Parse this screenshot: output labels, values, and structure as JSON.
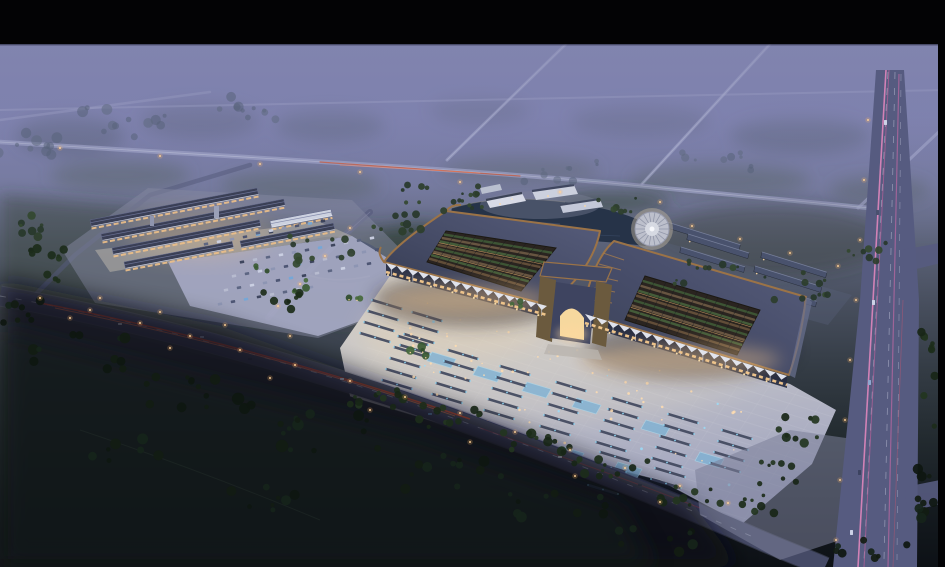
{
  "scene": {
    "kind": "aerial architectural rendering at dusk",
    "subject": "large Chinese-style market hall complex with illuminated plaza, secondary market buildings, parking lots, pond, round pavilion, highways and dark farm fields",
    "letterbox": {
      "top_bar": true,
      "right_bar": true
    }
  },
  "palette": {
    "bar-black": "#030305",
    "mist": "#7c7fab",
    "copper": "#9b7347",
    "roof-slate": "#3a3f55",
    "roof-slate-east": "#49526d",
    "opening-dark": "#2a2420",
    "plaza-warm": "#d8d1c5",
    "plaza-cool": "#9fa3bf",
    "road": "#454a66",
    "road-vertical": "#565b80",
    "water": "#263348",
    "water-west": "#22304a",
    "warm-light": "#ffd398",
    "warm-glow": "#f7c98e",
    "blue-light": "#8fd9f8",
    "pink-streak": "#e789c0",
    "red-streak": "#cf4a34",
    "tree-dark": "#1c2c1a",
    "field-dark": "#0b0f14",
    "white-awning": "#e8ebf4"
  },
  "decor": {
    "tree_tones": {
      "mist": [
        "#57637a",
        "#5e6a80"
      ],
      "mid": [
        "#2c3e2b",
        "#33482f",
        "#27372a"
      ],
      "dark": [
        "#1c2c1a",
        "#233520",
        "#182617"
      ],
      "vdark": [
        "#121c12",
        "#16241a",
        "#0e1710"
      ],
      "bright": [
        "#3a5a33",
        "#47693c",
        "#2f4c2a"
      ]
    },
    "tree_clusters": [
      {
        "x": 30,
        "y": 140,
        "rx": 40,
        "ry": 16,
        "n": 12,
        "tone": "mist",
        "s": 1.2
      },
      {
        "x": 130,
        "y": 122,
        "rx": 50,
        "ry": 15,
        "n": 12,
        "tone": "mist",
        "s": 1.2
      },
      {
        "x": 235,
        "y": 108,
        "rx": 45,
        "ry": 13,
        "n": 10,
        "tone": "mist",
        "s": 1.1
      },
      {
        "x": 45,
        "y": 265,
        "rx": 25,
        "ry": 18,
        "n": 10,
        "tone": "dark",
        "s": 1.1
      },
      {
        "x": 25,
        "y": 228,
        "rx": 20,
        "ry": 13,
        "n": 8,
        "tone": "mid",
        "s": 1
      },
      {
        "x": 320,
        "y": 252,
        "rx": 33,
        "ry": 17,
        "n": 12,
        "tone": "mid",
        "s": 1
      },
      {
        "x": 398,
        "y": 226,
        "rx": 28,
        "ry": 13,
        "n": 10,
        "tone": "mid",
        "s": 0.9
      },
      {
        "x": 282,
        "y": 300,
        "rx": 20,
        "ry": 11,
        "n": 8,
        "tone": "dark",
        "s": 0.9
      },
      {
        "x": 440,
        "y": 192,
        "rx": 42,
        "ry": 11,
        "n": 10,
        "tone": "mid",
        "s": 0.8
      },
      {
        "x": 560,
        "y": 172,
        "rx": 48,
        "ry": 11,
        "n": 9,
        "tone": "mist",
        "s": 0.9
      },
      {
        "x": 700,
        "y": 162,
        "rx": 55,
        "ry": 12,
        "n": 9,
        "tone": "mist",
        "s": 0.9
      },
      {
        "x": 700,
        "y": 270,
        "rx": 38,
        "ry": 15,
        "n": 11,
        "tone": "mid",
        "s": 0.8
      },
      {
        "x": 800,
        "y": 287,
        "rx": 38,
        "ry": 15,
        "n": 11,
        "tone": "mid",
        "s": 0.8
      },
      {
        "x": 862,
        "y": 252,
        "rx": 24,
        "ry": 11,
        "n": 8,
        "tone": "mid",
        "s": 0.8
      },
      {
        "x": 380,
        "y": 398,
        "rx": 30,
        "ry": 11,
        "n": 11,
        "tone": "dark",
        "s": 1
      },
      {
        "x": 452,
        "y": 416,
        "rx": 34,
        "ry": 11,
        "n": 12,
        "tone": "dark",
        "s": 1
      },
      {
        "x": 532,
        "y": 442,
        "rx": 38,
        "ry": 11,
        "n": 12,
        "tone": "dark",
        "s": 1.05
      },
      {
        "x": 612,
        "y": 468,
        "rx": 38,
        "ry": 11,
        "n": 12,
        "tone": "dark",
        "s": 1.05
      },
      {
        "x": 690,
        "y": 494,
        "rx": 33,
        "ry": 11,
        "n": 10,
        "tone": "dark",
        "s": 1
      },
      {
        "x": 80,
        "y": 352,
        "rx": 48,
        "ry": 18,
        "n": 12,
        "tone": "vdark",
        "s": 1.3
      },
      {
        "x": 200,
        "y": 392,
        "rx": 58,
        "ry": 20,
        "n": 14,
        "tone": "vdark",
        "s": 1.3
      },
      {
        "x": 330,
        "y": 432,
        "rx": 58,
        "ry": 20,
        "n": 14,
        "tone": "vdark",
        "s": 1.3
      },
      {
        "x": 450,
        "y": 472,
        "rx": 52,
        "ry": 18,
        "n": 12,
        "tone": "vdark",
        "s": 1.25
      },
      {
        "x": 558,
        "y": 506,
        "rx": 48,
        "ry": 16,
        "n": 10,
        "tone": "vdark",
        "s": 1.2
      },
      {
        "x": 120,
        "y": 452,
        "rx": 40,
        "ry": 15,
        "n": 8,
        "tone": "vdark",
        "s": 1.2
      },
      {
        "x": 262,
        "y": 500,
        "rx": 42,
        "ry": 15,
        "n": 8,
        "tone": "vdark",
        "s": 1.2
      },
      {
        "x": 30,
        "y": 312,
        "rx": 28,
        "ry": 13,
        "n": 8,
        "tone": "vdark",
        "s": 1.1
      },
      {
        "x": 655,
        "y": 540,
        "rx": 38,
        "ry": 13,
        "n": 8,
        "tone": "vdark",
        "s": 1.2
      },
      {
        "x": 800,
        "y": 432,
        "rx": 22,
        "ry": 15,
        "n": 9,
        "tone": "dark",
        "s": 1
      },
      {
        "x": 778,
        "y": 472,
        "rx": 19,
        "ry": 13,
        "n": 8,
        "tone": "dark",
        "s": 1
      },
      {
        "x": 758,
        "y": 502,
        "rx": 17,
        "ry": 11,
        "n": 7,
        "tone": "dark",
        "s": 1
      },
      {
        "x": 928,
        "y": 380,
        "rx": 9,
        "ry": 55,
        "n": 12,
        "tone": "dark",
        "s": 1
      },
      {
        "x": 925,
        "y": 490,
        "rx": 11,
        "ry": 38,
        "n": 9,
        "tone": "vdark",
        "s": 1.1
      },
      {
        "x": 872,
        "y": 552,
        "rx": 36,
        "ry": 12,
        "n": 8,
        "tone": "vdark",
        "s": 1.1
      },
      {
        "x": 470,
        "y": 202,
        "rx": 28,
        "ry": 9,
        "n": 8,
        "tone": "mid",
        "s": 0.8
      },
      {
        "x": 612,
        "y": 206,
        "rx": 24,
        "ry": 9,
        "n": 7,
        "tone": "mid",
        "s": 0.8
      },
      {
        "x": 300,
        "y": 286,
        "rx": 9,
        "ry": 6,
        "n": 4,
        "tone": "bright",
        "s": 0.9
      },
      {
        "x": 262,
        "y": 266,
        "rx": 8,
        "ry": 5,
        "n": 3,
        "tone": "bright",
        "s": 0.9
      },
      {
        "x": 352,
        "y": 300,
        "rx": 9,
        "ry": 5,
        "n": 3,
        "tone": "bright",
        "s": 0.9
      },
      {
        "x": 420,
        "y": 352,
        "rx": 10,
        "ry": 6,
        "n": 4,
        "tone": "bright",
        "s": 0.9
      },
      {
        "x": 520,
        "y": 302,
        "rx": 8,
        "ry": 5,
        "n": 3,
        "tone": "bright",
        "s": 0.9
      }
    ],
    "car_rows": [
      {
        "x": 242,
        "y": 262,
        "n": 11
      },
      {
        "x": 234,
        "y": 276,
        "n": 12
      },
      {
        "x": 226,
        "y": 290,
        "n": 12
      },
      {
        "x": 220,
        "y": 304,
        "n": 8
      },
      {
        "x": 206,
        "y": 244,
        "n": 6
      },
      {
        "x": 258,
        "y": 233,
        "n": 6
      }
    ],
    "stall_groups": [
      {
        "x": 398,
        "y": 336,
        "n": 5
      },
      {
        "x": 448,
        "y": 350,
        "n": 5
      },
      {
        "x": 500,
        "y": 366,
        "n": 5
      },
      {
        "x": 556,
        "y": 382,
        "n": 5
      },
      {
        "x": 612,
        "y": 398,
        "n": 5
      },
      {
        "x": 668,
        "y": 414,
        "n": 5
      },
      {
        "x": 722,
        "y": 430,
        "n": 4
      },
      {
        "x": 600,
        "y": 452,
        "n": 4
      },
      {
        "x": 655,
        "y": 468,
        "n": 3
      },
      {
        "x": 372,
        "y": 300,
        "n": 4
      },
      {
        "x": 412,
        "y": 312,
        "n": 4
      }
    ],
    "pools": [
      {
        "x": 432,
        "y": 352
      },
      {
        "x": 478,
        "y": 366
      },
      {
        "x": 527,
        "y": 382
      },
      {
        "x": 577,
        "y": 398
      },
      {
        "x": 500,
        "y": 430
      },
      {
        "x": 560,
        "y": 446
      },
      {
        "x": 618,
        "y": 462
      },
      {
        "x": 646,
        "y": 420
      },
      {
        "x": 700,
        "y": 452
      }
    ],
    "west_buildings": [
      {
        "x": 90,
        "y": 220,
        "len": 170
      },
      {
        "x": 101,
        "y": 234,
        "len": 186
      },
      {
        "x": 112,
        "y": 248,
        "len": 150
      },
      {
        "x": 270,
        "y": 221,
        "len": 62,
        "white": true
      },
      {
        "x": 124,
        "y": 262,
        "len": 110
      },
      {
        "x": 240,
        "y": 241,
        "len": 95
      }
    ],
    "east_buildings": [
      {
        "x": 664,
        "y": 221,
        "len": 80
      },
      {
        "x": 688,
        "y": 234,
        "len": 64
      },
      {
        "x": 681,
        "y": 247,
        "len": 67
      },
      {
        "x": 674,
        "y": 260,
        "len": 70
      },
      {
        "x": 667,
        "y": 273,
        "len": 72
      },
      {
        "x": 762,
        "y": 252,
        "len": 68
      },
      {
        "x": 755,
        "y": 266,
        "len": 70
      },
      {
        "x": 748,
        "y": 280,
        "len": 72
      },
      {
        "x": 741,
        "y": 294,
        "len": 60
      }
    ],
    "hall_openings": [
      {
        "quad": [
          [
            446,
            231
          ],
          [
            556,
            248
          ],
          [
            521,
            291
          ],
          [
            427,
            262
          ]
        ],
        "rows": 9,
        "cols": 11
      },
      {
        "quad": [
          [
            645,
            276
          ],
          [
            760,
            310
          ],
          [
            737,
            355
          ],
          [
            625,
            320
          ]
        ],
        "rows": 9,
        "cols": 11
      }
    ],
    "awning_runs": [
      {
        "from": [
          386,
          263
        ],
        "to": [
          547,
          306
        ],
        "n": 15
      },
      {
        "from": [
          585,
          314
        ],
        "to": [
          787,
          376
        ],
        "n": 18
      }
    ],
    "pavilion": {
      "cx": 652,
      "cy": 229,
      "r": 17,
      "spokes": 18
    },
    "plaza_quad": [
      [
        400,
        295
      ],
      [
        775,
        392
      ],
      [
        724,
        502
      ],
      [
        365,
        392
      ]
    ],
    "plaza_dots": 70,
    "lamp_points": [
      [
        40,
        298
      ],
      [
        90,
        310
      ],
      [
        140,
        323
      ],
      [
        190,
        336
      ],
      [
        240,
        350
      ],
      [
        295,
        365
      ],
      [
        350,
        381
      ],
      [
        405,
        397
      ],
      [
        460,
        413
      ],
      [
        515,
        432
      ],
      [
        570,
        450
      ],
      [
        625,
        468
      ],
      [
        680,
        486
      ],
      [
        728,
        503
      ],
      [
        70,
        318
      ],
      [
        170,
        348
      ],
      [
        270,
        378
      ],
      [
        370,
        410
      ],
      [
        470,
        442
      ],
      [
        575,
        476
      ],
      [
        660,
        502
      ],
      [
        350,
        228
      ],
      [
        325,
        256
      ],
      [
        300,
        284
      ],
      [
        278,
        306
      ],
      [
        60,
        148
      ],
      [
        160,
        156
      ],
      [
        260,
        164
      ],
      [
        360,
        172
      ],
      [
        460,
        182
      ],
      [
        560,
        192
      ],
      [
        660,
        202
      ],
      [
        692,
        226
      ],
      [
        740,
        239
      ],
      [
        790,
        253
      ],
      [
        838,
        266
      ],
      [
        100,
        298
      ],
      [
        160,
        312
      ],
      [
        225,
        325
      ],
      [
        290,
        336
      ],
      [
        868,
        120
      ],
      [
        864,
        180
      ],
      [
        860,
        240
      ],
      [
        856,
        300
      ],
      [
        850,
        360
      ],
      [
        845,
        420
      ],
      [
        840,
        480
      ],
      [
        836,
        540
      ]
    ]
  }
}
